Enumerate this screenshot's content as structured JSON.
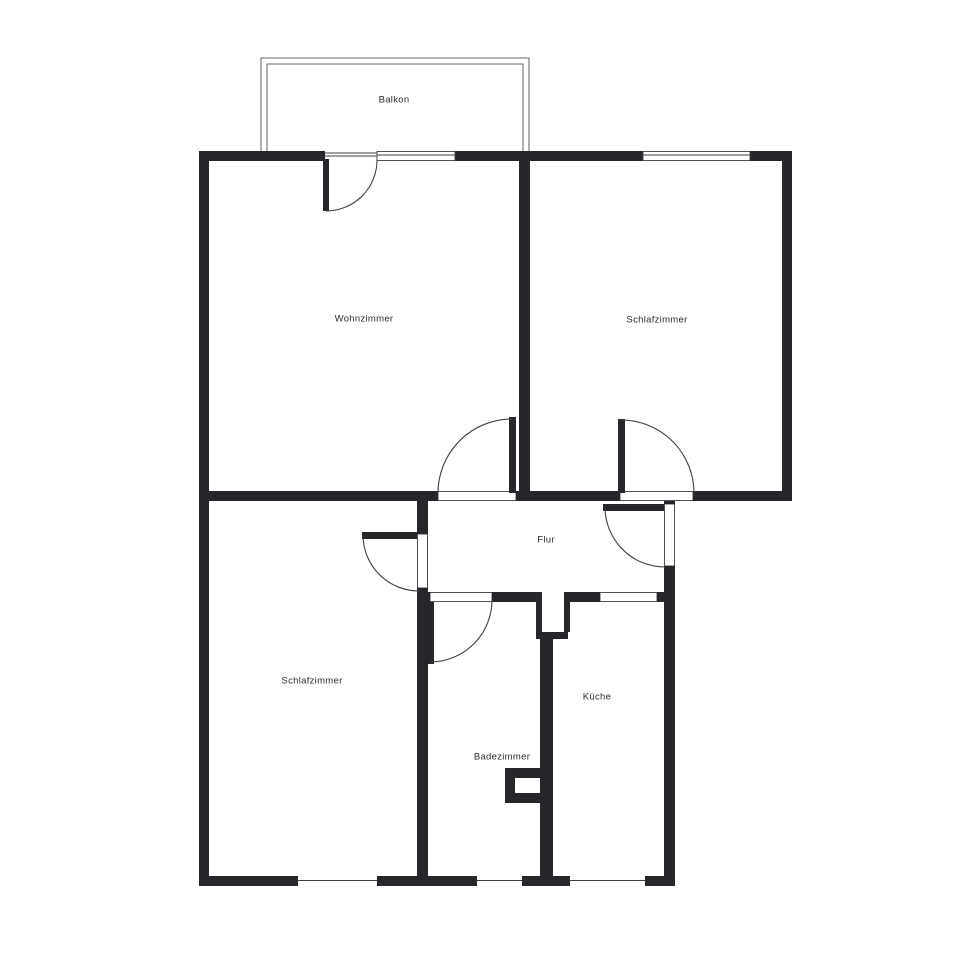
{
  "plan": {
    "type": "floor-plan",
    "rooms": [
      {
        "id": "balkon",
        "label": "Balkon"
      },
      {
        "id": "wohnzimmer",
        "label": "Wohnzimmer"
      },
      {
        "id": "schlafzimmer-top",
        "label": "Schlafzimmer"
      },
      {
        "id": "flur",
        "label": "Flur"
      },
      {
        "id": "schlafzimmer-bottom",
        "label": "Schlafzimmer"
      },
      {
        "id": "badezimmer",
        "label": "Badezimmer"
      },
      {
        "id": "kueche",
        "label": "Küche"
      }
    ],
    "doors": [
      {
        "id": "balcony-door",
        "between": "Balkon / Wohnzimmer"
      },
      {
        "id": "wohnzimmer-door",
        "between": "Flur / Wohnzimmer"
      },
      {
        "id": "schlafzimmer-top-door",
        "between": "Flur / Schlafzimmer"
      },
      {
        "id": "entrance-door",
        "between": "Flur / outside"
      },
      {
        "id": "schlafzimmer-bottom-door",
        "between": "Flur / Schlafzimmer"
      },
      {
        "id": "badezimmer-door",
        "between": "Flur / Badezimmer"
      },
      {
        "id": "kueche-doorway",
        "between": "Flur / Küche"
      }
    ],
    "windows": [
      {
        "id": "window-wohnzimmer-top"
      },
      {
        "id": "window-schlafzimmer-top"
      },
      {
        "id": "window-schlafzimmer-bottom"
      },
      {
        "id": "window-badezimmer-bottom"
      },
      {
        "id": "window-kueche-bottom"
      }
    ],
    "colors": {
      "wall": "#26262b",
      "thin_line": "#3f3f46",
      "balcony_line": "#6a6a72",
      "text": "#2b2b31",
      "background": "#ffffff"
    }
  }
}
